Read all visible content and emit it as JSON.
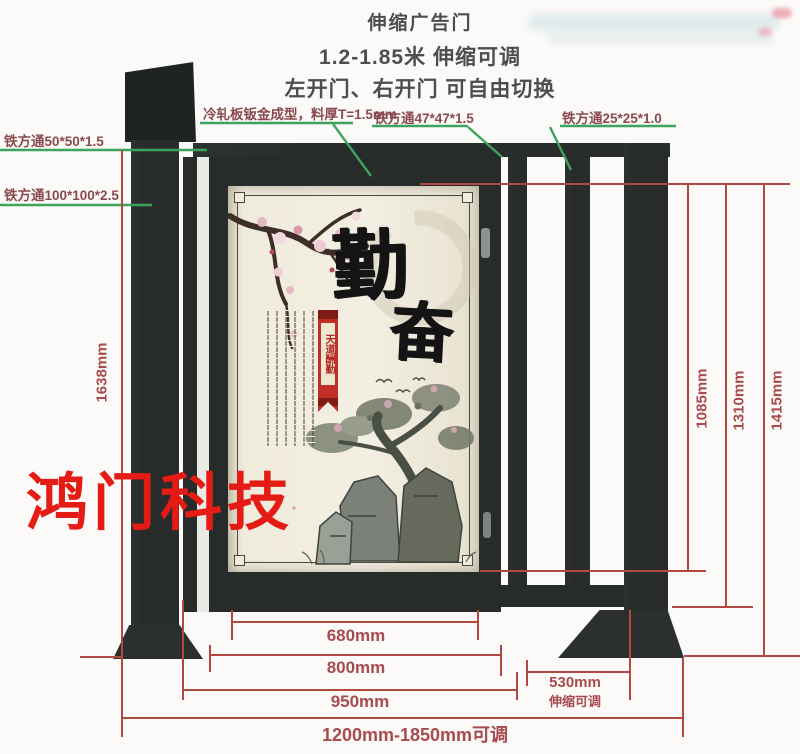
{
  "header": {
    "line1": "伸缩广告门",
    "line2": "1.2-1.85米 伸缩可调",
    "line3": "左开门、右开门 可自由切换"
  },
  "callouts": {
    "panel_material": "冷轧板钣金成型，料厚T=1.5mm",
    "tube_50": "铁方通50*50*1.5",
    "tube_100": "铁方通100*100*2.5",
    "tube_47": "铁方通47*47*1.5",
    "tube_25": "铁方通25*25*1.0"
  },
  "dimensions": {
    "height_left": "1638mm",
    "height_inner": "1085mm",
    "height_mid": "1310mm",
    "height_outer": "1415mm",
    "width_panel": "680mm",
    "width_door": "800mm",
    "width_frame": "950mm",
    "width_range": "1200mm-1850mm可调",
    "ext_width": "530mm",
    "ext_note": "伸缩可调"
  },
  "poster": {
    "big_char_1": "勤",
    "big_char_2": "奋",
    "ribbon_text": "天道酬勤"
  },
  "watermark": "鸿门科技",
  "colors": {
    "annotation_green": "#3da45e",
    "dimension_red": "#b2493f",
    "watermark_red": "#e51c15",
    "structure_dark": "#272b29",
    "poster_cream": "#f0ebdc"
  }
}
